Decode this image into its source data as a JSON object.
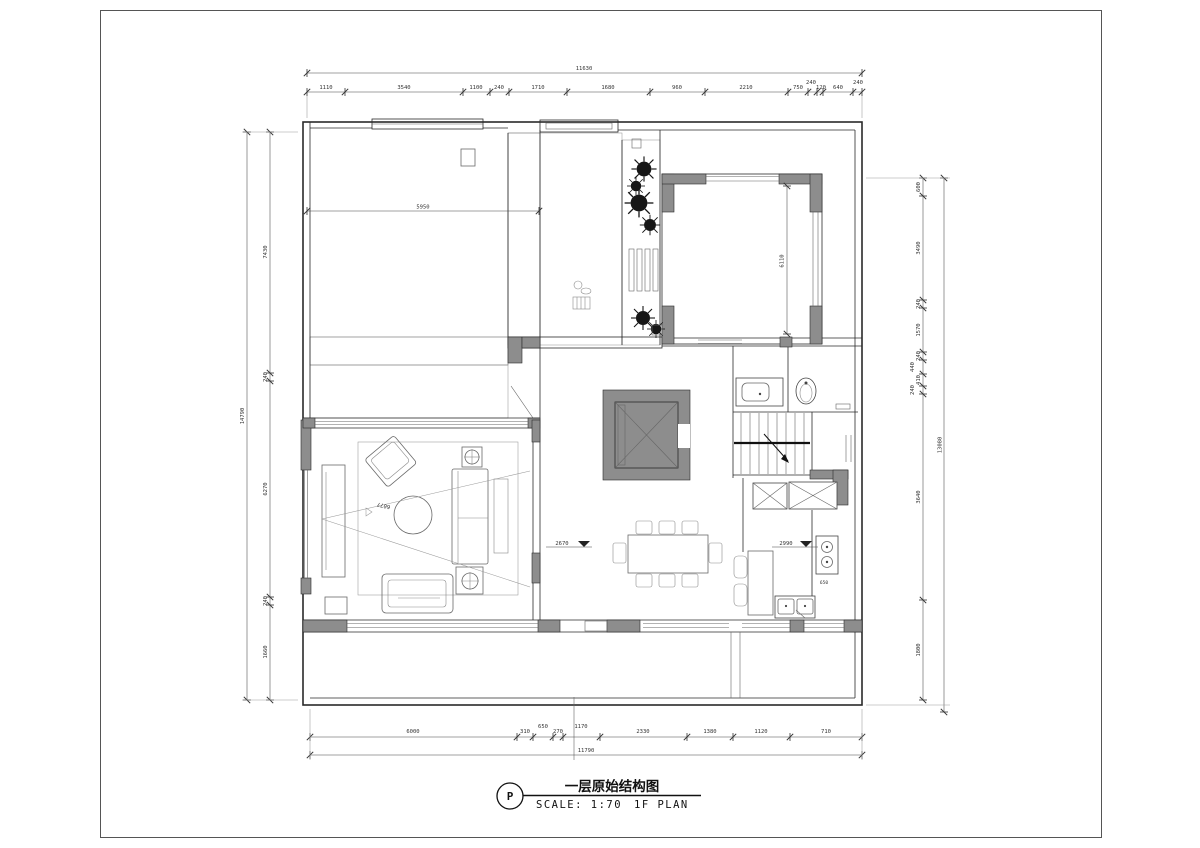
{
  "title_block": {
    "symbol": "P",
    "title": "一层原始结构图",
    "scale_label": "SCALE: 1:70",
    "plan_label": "1F PLAN"
  },
  "dimensions": {
    "top": {
      "total": "11630",
      "segments": [
        "1110",
        "3540",
        "1100",
        "240",
        "1710",
        "1680",
        "960",
        "2210",
        "750",
        "240",
        "120",
        "640",
        "240"
      ]
    },
    "bottom": {
      "total": "11790",
      "segments": [
        "6000",
        "310",
        "650",
        "270",
        "1170",
        "2330",
        "1380",
        "1120",
        "710"
      ]
    },
    "left": {
      "total": "14790",
      "segments": [
        "7430",
        "240",
        "6270",
        "240",
        "1660"
      ]
    },
    "right": {
      "total": "13080",
      "segments": [
        "600",
        "3490",
        "240",
        "1570",
        "240",
        "440",
        "410",
        "240",
        "3640",
        "1800"
      ]
    }
  },
  "annotations": {
    "room_width": "5950",
    "courtyard_height": "6110",
    "living_diagonal": "6077",
    "level_dining": "2670",
    "level_kitchen": "2990",
    "counter_depth": "650"
  },
  "colors": {
    "wall_line": "#2a2a2a",
    "wall_fill": "#8d8d8d",
    "hatch": "#aaaaaa",
    "background": "#ffffff"
  }
}
